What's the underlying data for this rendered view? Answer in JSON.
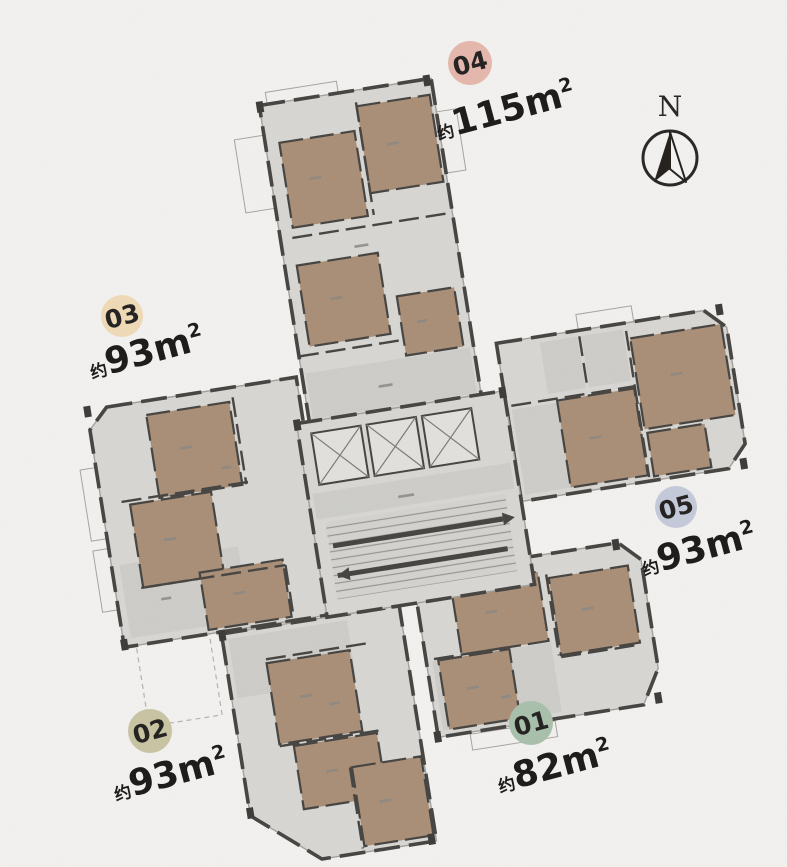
{
  "page": {
    "background_color": "#f2f1ef"
  },
  "plan": {
    "type": "residential-tower-floor-plate",
    "colors": {
      "floor_fill": "#d7d6d3",
      "bedroom_fill": "#a98e76",
      "wall_color": "#454340",
      "balcony_fill": "#f1f0ee"
    }
  },
  "north_indicator": {
    "label": "N"
  },
  "units": [
    {
      "id": "01",
      "badge_color": "#a8bfab",
      "approx": "约",
      "area_value": "82",
      "area_unit": "m",
      "area_sup": "2",
      "area_label": "约82m²"
    },
    {
      "id": "02",
      "badge_color": "#c8c3a2",
      "approx": "约",
      "area_value": "93",
      "area_unit": "m",
      "area_sup": "2",
      "area_label": "约93m²"
    },
    {
      "id": "03",
      "badge_color": "#edd9b6",
      "approx": "约",
      "area_value": "93",
      "area_unit": "m",
      "area_sup": "2",
      "area_label": "约93m²"
    },
    {
      "id": "04",
      "badge_color": "#e3b7ac",
      "approx": "约",
      "area_value": "115",
      "area_unit": "m",
      "area_sup": "2",
      "area_label": "约115m²"
    },
    {
      "id": "05",
      "badge_color": "#c3c9d8",
      "approx": "约",
      "area_value": "93",
      "area_unit": "m",
      "area_sup": "2",
      "area_label": "约93m²"
    }
  ]
}
